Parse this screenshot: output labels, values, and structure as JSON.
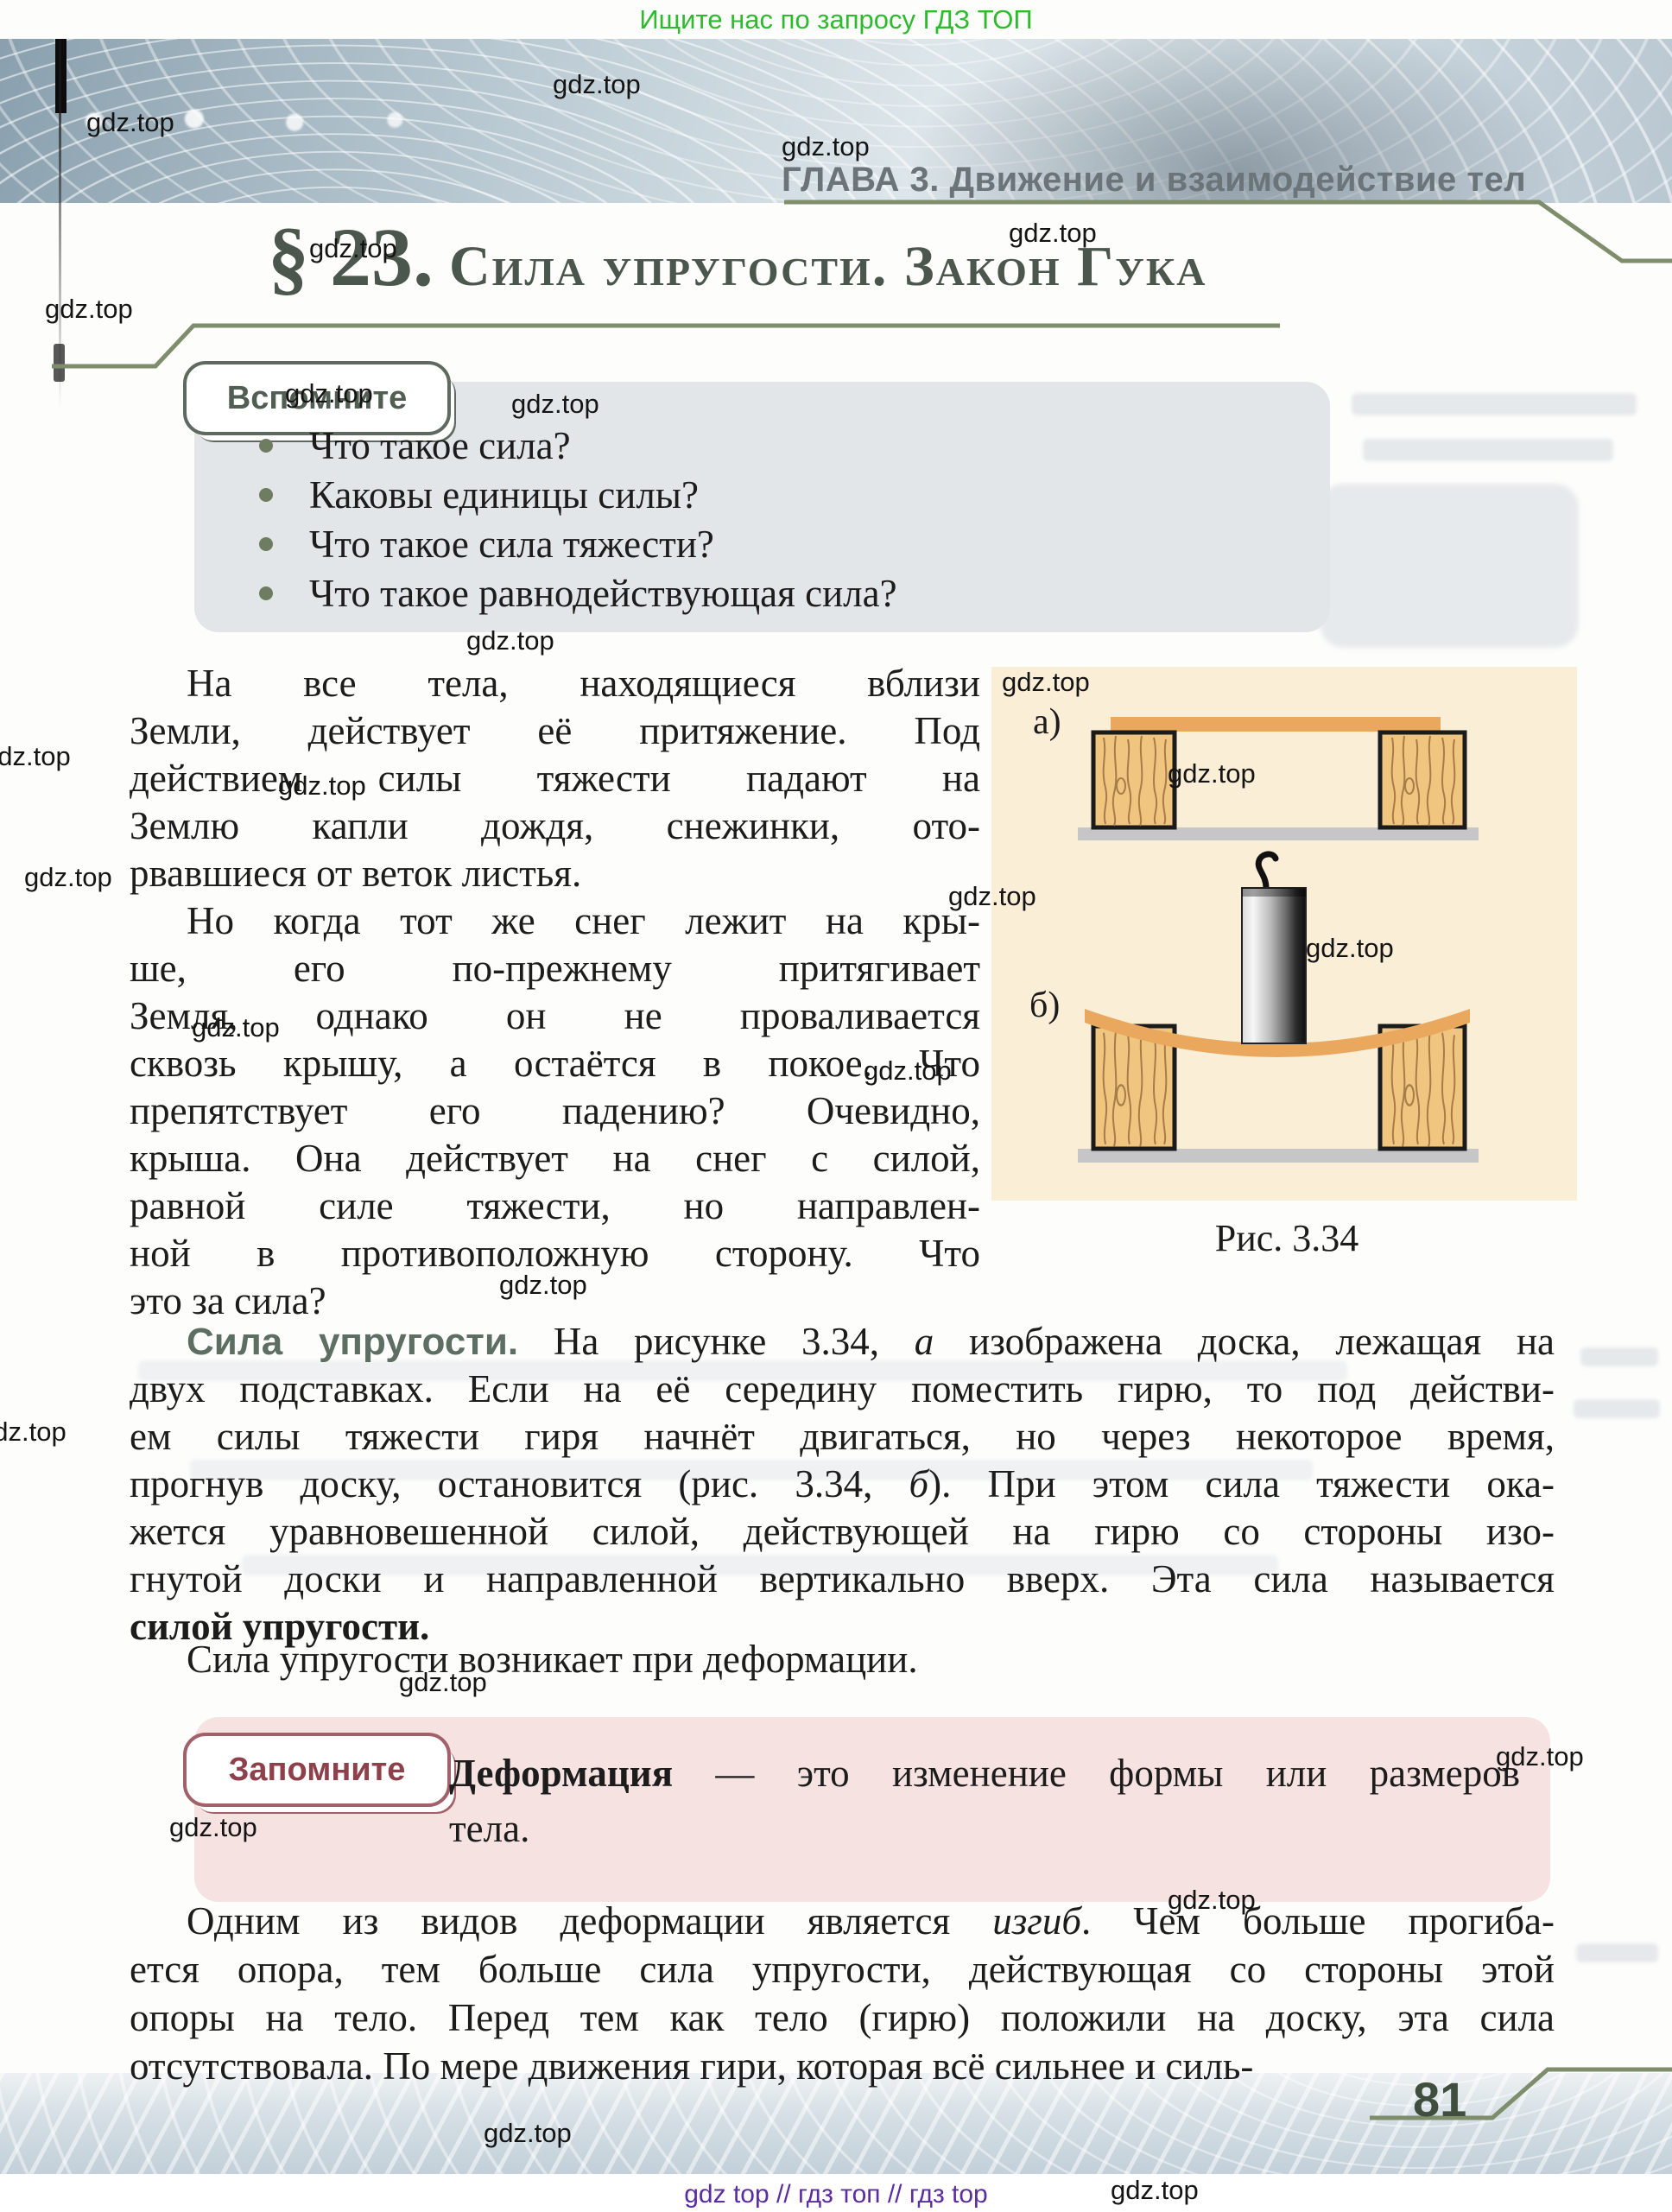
{
  "meta": {
    "promo_top": "Ищите нас по запросу ГДЗ ТОП",
    "watermark": "gdz.top",
    "footer": "gdz top  //  гдз топ  //  гдз top"
  },
  "header": {
    "chapter": "ГЛАВА 3. Движение и взаимодействие тел"
  },
  "title": {
    "number": "§ 23.",
    "text": "Сила упругости. Закон Гука"
  },
  "vspomnite": {
    "badge": "Вспомните",
    "items": [
      "Что такое сила?",
      "Каковы единицы силы?",
      "Что такое сила тяжести?",
      "Что такое равнодействующая сила?"
    ]
  },
  "body": {
    "p1": {
      "lines": [
        "На все тела, находящиеся вблизи",
        "Земли, действует её притяжение. Под",
        "действием силы тяжести падают на",
        "Землю капли дождя, снежинки, ото-",
        "рвавшиеся от веток листья."
      ]
    },
    "p2": {
      "lines": [
        "Но когда тот же снег лежит на кры-",
        "ше, его по-прежнему притягивает",
        "Земля, однако он не проваливается",
        "сквозь крышу, а остаётся в покое. Что",
        "препятствует его падению? Очевидно,",
        "крыша. Она действует на снег с силой,",
        "равной силе тяжести, но направлен-",
        "ной в противоположную сторону. Что",
        "это за сила?"
      ]
    },
    "p3": {
      "lead": "Сила упругости.",
      "l1a": " На рисунке 3.34, ",
      "l1b": "а",
      "l1c": " изображена доска, лежащая на",
      "l2": "двух подставках. Если на её середину поместить гирю, то под действи-",
      "l3": "ем силы тяжести гиря начнёт двигаться, но через некоторое время,",
      "l4a": "прогнув доску, остановится (рис. 3.34, ",
      "l4b": "б",
      "l4c": "). При этом сила тяжести ока-",
      "l5": "жется уравновешенной силой, действующей на гирю со стороны изо-",
      "l6": "гнутой доски и направленной вертикально вверх. Эта сила называется",
      "l7": "силой упругости."
    },
    "p4": "Сила упругости возникает при деформации.",
    "p5": {
      "l1a": "Одним из видов деформации является ",
      "l1b": "изгиб",
      "l1c": ". Чем больше прогиба-",
      "l2": "ется опора, тем больше сила упругости, действующая со стороны этой",
      "l3": "опоры на тело. Перед тем как тело (гирю) положили на доску, эта сила",
      "l4": "отсутствовала. По мере движения гири, которая всё сильнее и силь-"
    }
  },
  "figure": {
    "label_a": "а)",
    "label_b": "б)",
    "caption": "Рис. 3.34"
  },
  "zapomnite": {
    "badge": "Запомните",
    "term": "Деформация",
    "def_rest": " — это изменение формы или размеров",
    "def_line2": "тела."
  },
  "page": {
    "number": "81"
  }
}
